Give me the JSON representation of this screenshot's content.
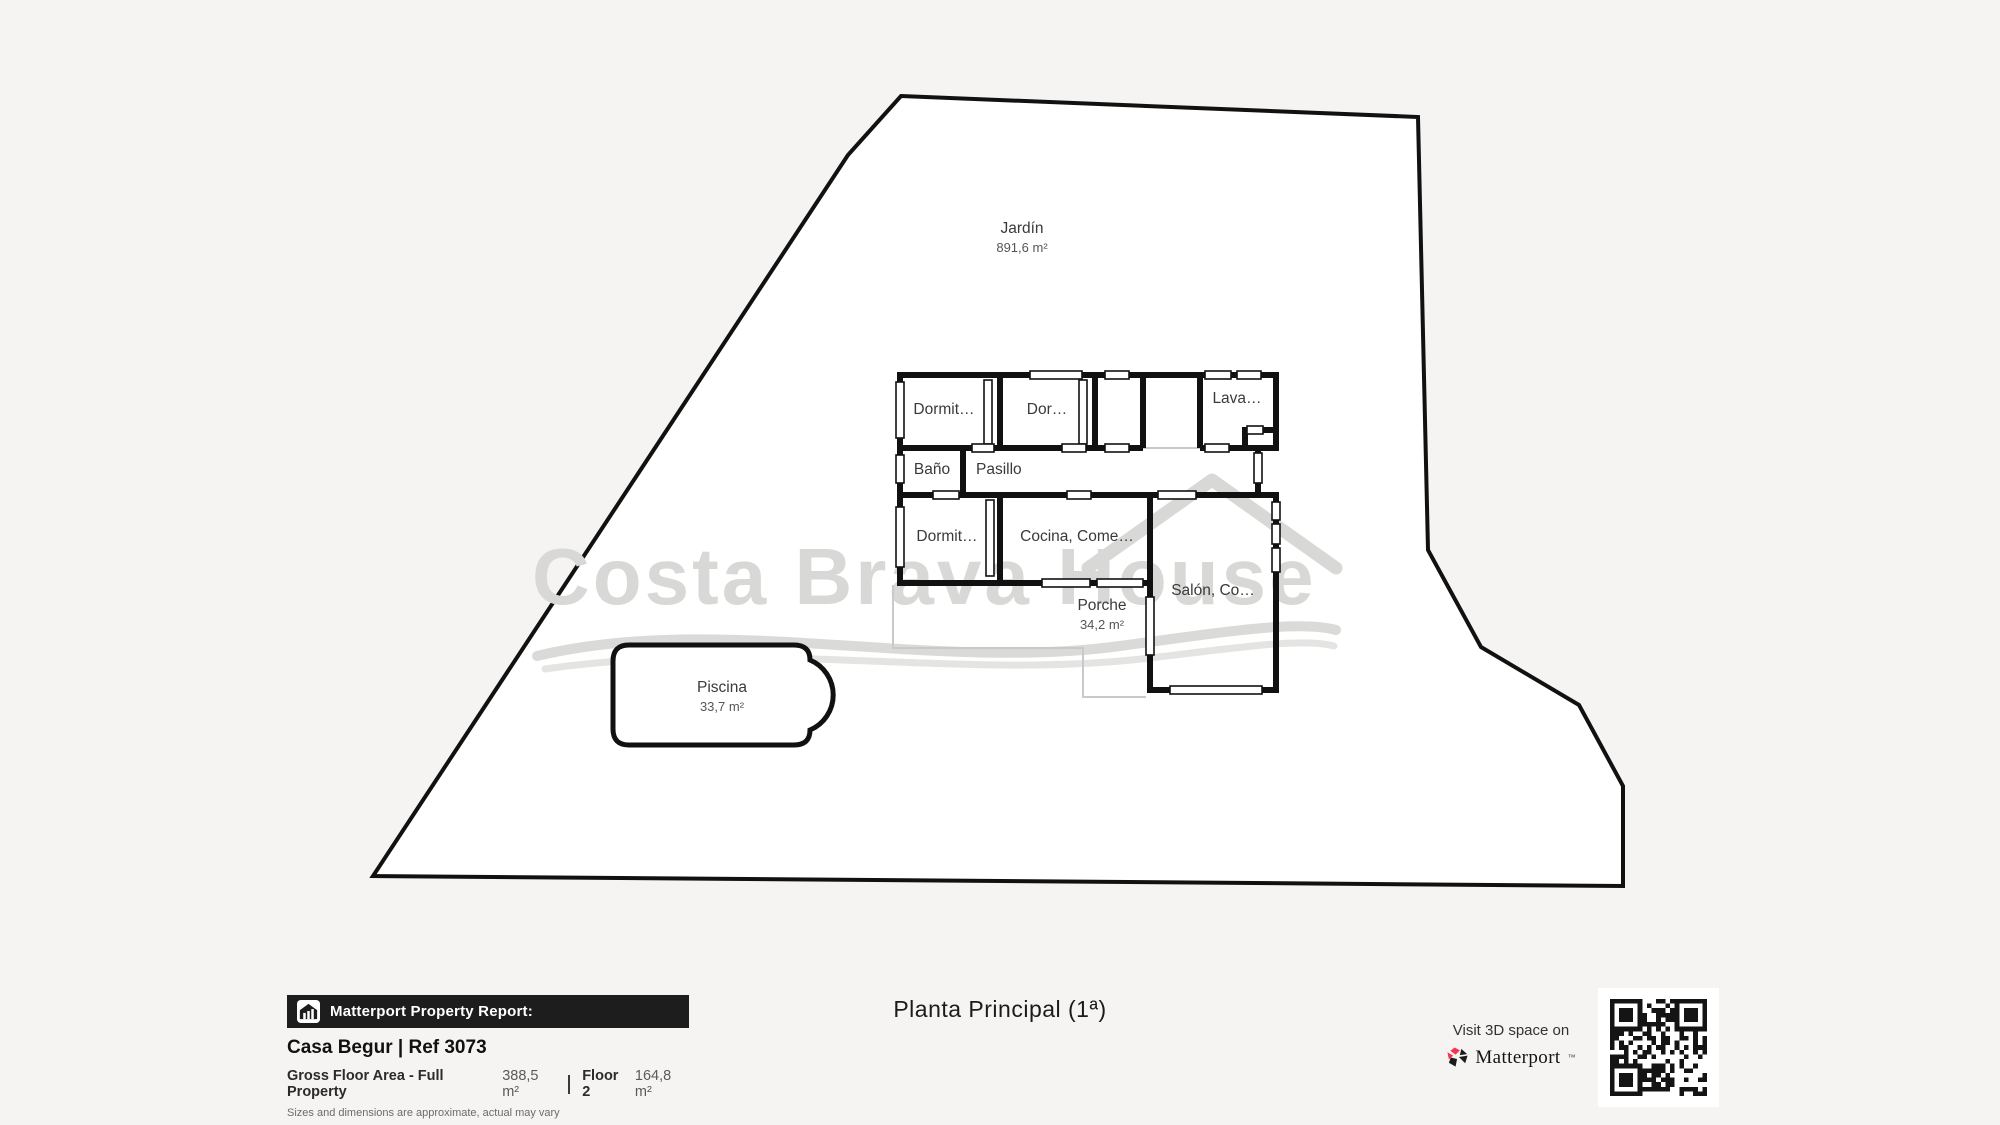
{
  "colors": {
    "background": "#f5f4f2",
    "wall": "#111111",
    "watermark_gray": "#d8d8d6",
    "porch_outline_gray": "#c9c9c9",
    "matterport_pink": "#f4364c",
    "report_bar_black": "#1d1d1d"
  },
  "plan": {
    "watermark_text": "Costa Brava House",
    "jardin": {
      "name": "Jardín",
      "area": "891,6 m²"
    },
    "rooms": {
      "dormitorio_top": "Dormit…",
      "dormitorio_top2": "Dor…",
      "lavadero": "Lava…",
      "bano": "Baño",
      "pasillo": "Pasillo",
      "dormitorio_lower": "Dormit…",
      "cocina": "Cocina, Come…",
      "salon": "Salón, Co…"
    },
    "porche": {
      "name": "Porche",
      "area": "34,2 m²"
    },
    "piscina": {
      "name": "Piscina",
      "area": "33,7 m²"
    }
  },
  "footer": {
    "report": {
      "header": "Matterport Property Report:",
      "property_title": "Casa Begur | Ref 3073",
      "gross_area_label": "Gross Floor Area - Full Property",
      "gross_area_value": "388,5 m²",
      "floor_label": "Floor 2",
      "floor_value": "164,8 m²",
      "disclaimer": "Sizes and dimensions are approximate, actual may vary"
    },
    "floor_title": "Planta Principal (1ª)",
    "visit": {
      "line": "Visit 3D space on",
      "brand": "Matterport",
      "brand_mark": "™"
    }
  },
  "icons": {
    "report_icon": "house-bars-icon",
    "brand_icon": "matterport-pinwheel-icon",
    "qr": "qr-code"
  }
}
